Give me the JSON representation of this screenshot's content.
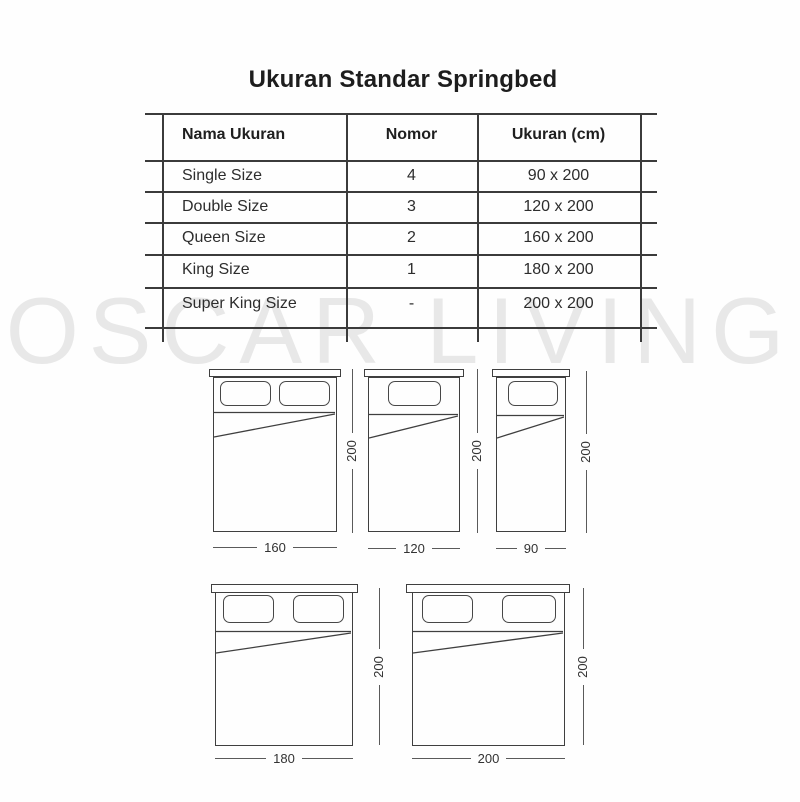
{
  "title": "Ukuran Standar Springbed",
  "watermark": "OSCAR LIVING",
  "table": {
    "headers": [
      "Nama Ukuran",
      "Nomor",
      "Ukuran (cm)"
    ],
    "rows": [
      {
        "name": "Single Size",
        "nomor": "4",
        "ukuran": "90 x 200"
      },
      {
        "name": "Double Size",
        "nomor": "3",
        "ukuran": "120 x 200"
      },
      {
        "name": "Queen Size",
        "nomor": "2",
        "ukuran": "160 x 200"
      },
      {
        "name": "King Size",
        "nomor": "1",
        "ukuran": "180 x 200"
      },
      {
        "name": "Super King Size",
        "nomor": "-",
        "ukuran": "200 x 200"
      }
    ]
  },
  "diagrams": [
    {
      "width_label": "160",
      "height_label": "200",
      "pillows": 2
    },
    {
      "width_label": "120",
      "height_label": "200",
      "pillows": 1
    },
    {
      "width_label": "90",
      "height_label": "200",
      "pillows": 1
    },
    {
      "width_label": "180",
      "height_label": "200",
      "pillows": 2
    },
    {
      "width_label": "200",
      "height_label": "200",
      "pillows": 2
    }
  ],
  "colors": {
    "line": "#3b3b3b",
    "dimension_line": "#5a5a5a",
    "text": "#2d2d2d",
    "watermark": "#e8e8e8",
    "background": "#fefefe"
  }
}
